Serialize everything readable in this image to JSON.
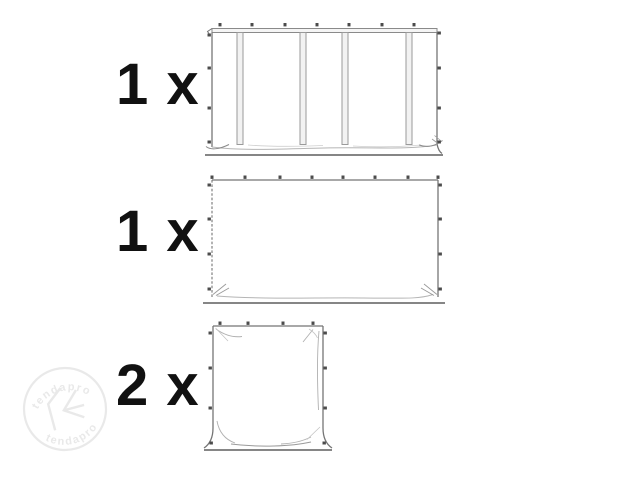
{
  "page": {
    "background": "#ffffff"
  },
  "items": [
    {
      "quantity": "1 x",
      "illustration": "sidewall-with-windows"
    },
    {
      "quantity": "1 x",
      "illustration": "plain-sidewall"
    },
    {
      "quantity": "2 x",
      "illustration": "narrow-end-wall"
    }
  ],
  "watermark": {
    "brand_top": "tendapro",
    "brand_bottom": "tendapro"
  },
  "colors": {
    "background": "#ffffff",
    "label_text": "#111111",
    "outline": "#757575",
    "fastener_dot": "#4c4c4c",
    "strip_fill": "#f2f2f2",
    "crease": "#b5b5b5",
    "ground_line": "#5f5f5f",
    "watermark": "#e9e9e9"
  }
}
